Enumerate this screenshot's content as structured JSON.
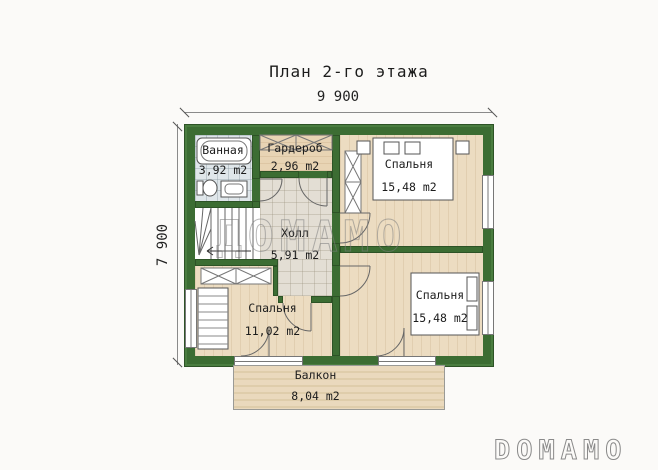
{
  "title": "План 2-го этажа",
  "dimensions": {
    "top": "9 900",
    "left": "7 900"
  },
  "rooms": {
    "bathroom": {
      "name": "Ванная",
      "area": "3,92 m2"
    },
    "wardrobe": {
      "name": "Гардероб",
      "area": "2,96 m2"
    },
    "hall": {
      "name": "Холл",
      "area": "5,91 m2"
    },
    "bedroom_top": {
      "name": "Спальня",
      "area": "15,48 m2"
    },
    "bedroom_left": {
      "name": "Спальня",
      "area": "11,02 m2"
    },
    "bedroom_right": {
      "name": "Спальня",
      "area": "15,48 m2"
    },
    "balcony": {
      "name": "Балкон",
      "area": "8,04 m2"
    }
  },
  "watermark": "ДОМАМО",
  "logo": "DOMAMO",
  "colors": {
    "wall_green": "#3c6d33",
    "wood_floor": "#ecdcc1",
    "bath_tile": "#dfe6ea",
    "hall_tile": "#e3ded4",
    "balcony_wood": "#ead9bd",
    "background": "#fbfaf8"
  }
}
